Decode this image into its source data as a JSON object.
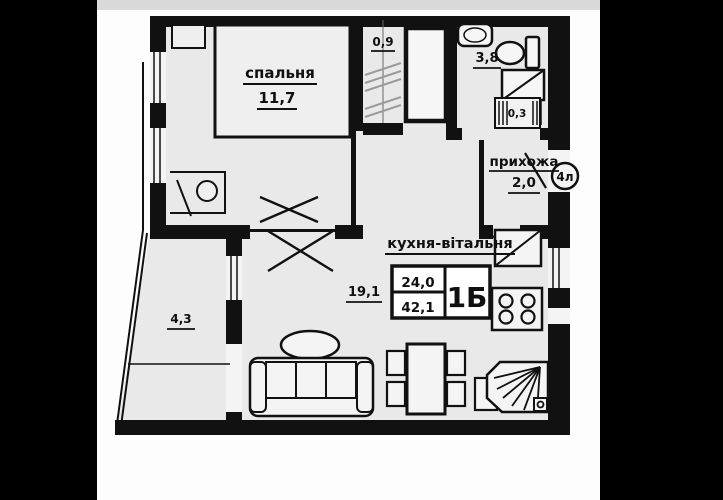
{
  "image": {
    "kind": "apartment floor plan photo on black backdrop"
  },
  "colors": {
    "backdrop": "#000000",
    "paper": "#fdfdfd",
    "wall": "#111111",
    "room_fill": "#e9e9e9",
    "hatch": "#9a9a9a"
  },
  "plan": {
    "rooms": {
      "bedroom": {
        "name": "спальня",
        "area": "11,7"
      },
      "loggia_small": {
        "area": "0,9"
      },
      "bathroom": {
        "area": "3,8"
      },
      "duct": {
        "area": "0,3"
      },
      "hallway": {
        "name": "прихожа",
        "area": "2,0"
      },
      "kitchen_living": {
        "name": "кухня-вітальня",
        "area": "19,1"
      },
      "balcony": {
        "area": "4,3"
      }
    },
    "stamp": {
      "living_area": "24,0",
      "total_area": "42,1",
      "unit_type": "1Б"
    },
    "floor_tag": "4л"
  }
}
